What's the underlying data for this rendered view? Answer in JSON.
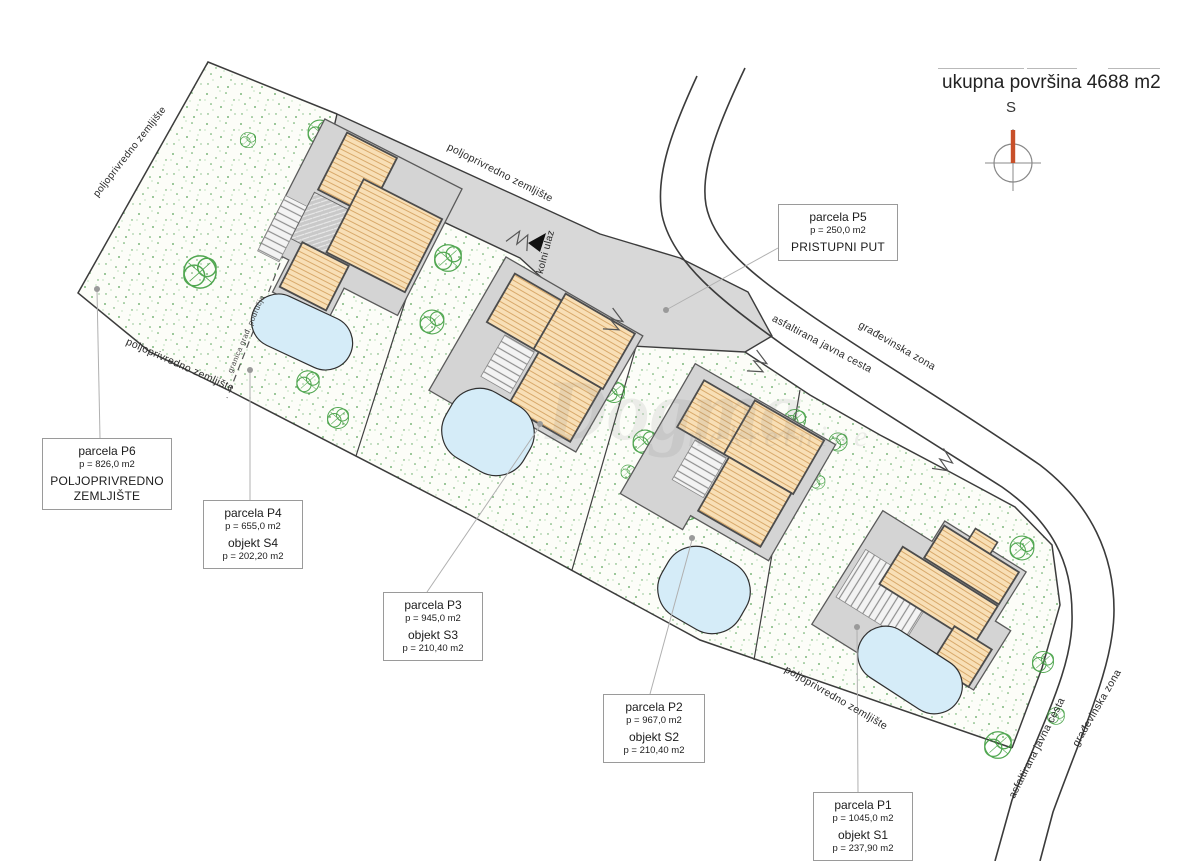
{
  "title": {
    "total_area": "ukupna površina 4688 m2"
  },
  "compass": {
    "north_letter": "S"
  },
  "watermark": {
    "brand": "Dogma",
    "subtitle": "nekretnine"
  },
  "map_texts": {
    "agricultural_land": "poljoprivredno zemljište",
    "public_road": "asfaltirana javna cesta",
    "building_zone": "građevinska zona",
    "vehicle_entrance": "kolni ulaz",
    "building_area_boundary": "granica građ. područja"
  },
  "parcel_labels": [
    {
      "title": "parcela P5",
      "area": "p = 250,0 m2",
      "subtitle": "PRISTUPNI PUT"
    },
    {
      "title": "parcela P6",
      "area": "p = 826,0 m2",
      "subtitle": "POLJOPRIVREDNO ZEMLJIŠTE"
    },
    {
      "title": "parcela P4",
      "area": "p = 655,0 m2",
      "object": "objekt S4",
      "object_area": "p = 202,20 m2"
    },
    {
      "title": "parcela P3",
      "area": "p = 945,0 m2",
      "object": "objekt S3",
      "object_area": "p = 210,40 m2"
    },
    {
      "title": "parcela P2",
      "area": "p = 967,0 m2",
      "object": "objekt S2",
      "object_area": "p = 210,40 m2"
    },
    {
      "title": "parcela P1",
      "area": "p = 1045,0 m2",
      "object": "objekt S1",
      "object_area": "p = 237,90 m2"
    }
  ]
}
